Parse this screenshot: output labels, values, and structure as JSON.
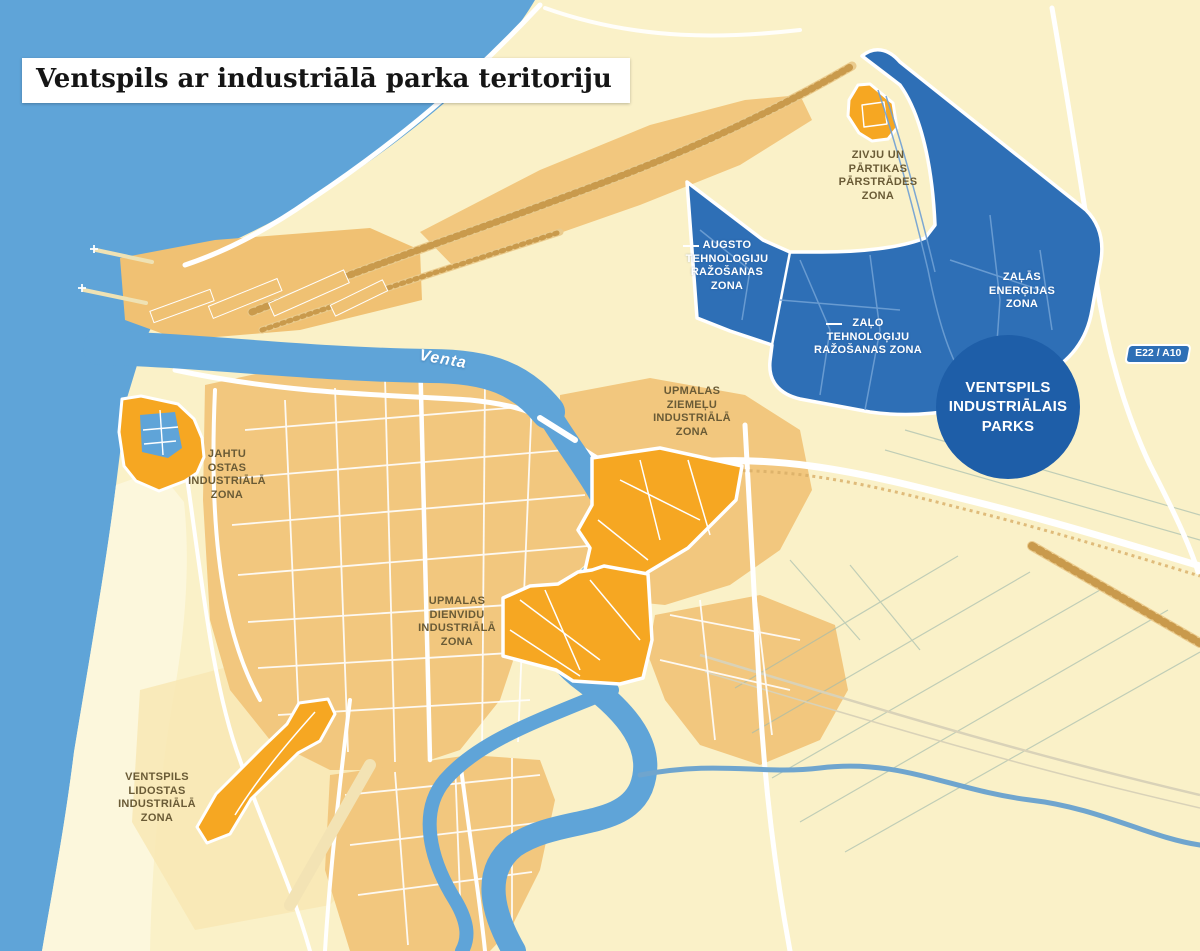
{
  "title": "Ventspils ar industriālā parka teritoriju",
  "labels": {
    "river": "Venta",
    "road_badge": "E22 / A10",
    "park_circle": "VENTSPILS\nINDUSTRIĀLAIS\nPARKS"
  },
  "zones": {
    "fish_food": {
      "label": "ZIVJU UN\nPĀRTIKAS\nPĀRSTRĀDES\nZONA",
      "category": "industrial-park-orange"
    },
    "high_tech": {
      "label": "AUGSTO\nTEHNOLOĢIJU\nRAŽOŠANAS\nZONA",
      "category": "industrial-park-blue"
    },
    "green_tech": {
      "label": "ZAĻO\nTEHNOLOĢIJU\nRAŽOŠANAS ZONA",
      "category": "industrial-park-blue"
    },
    "green_energy": {
      "label": "ZAĻĀS\nENERĢIJAS\nZONA",
      "category": "industrial-park-blue"
    },
    "upmalas_north": {
      "label": "UPMALAS\nZIEMEĻU\nINDUSTRIĀLĀ\nZONA",
      "category": "city-industrial-orange"
    },
    "yacht_port": {
      "label": "JAHTU\nOSTAS\nINDUSTRIĀLĀ\nZONA",
      "category": "city-industrial-orange"
    },
    "upmalas_south": {
      "label": "UPMALAS\nDIENVIDU\nINDUSTRIĀLĀ\nZONA",
      "category": "city-industrial-orange"
    },
    "airport": {
      "label": "VENTSPILS\nLIDOSTAS\nINDUSTRIĀLĀ\nZONA",
      "category": "city-industrial-orange"
    }
  },
  "colors": {
    "sea": "#5FA4D8",
    "land": "#FAF1C8",
    "urban": "#F2C77E",
    "industrial_zone_orange": "#F6A722",
    "park_zone_blue": "#2E6FB6",
    "park_circle_blue": "#1E5EA8",
    "label_brown": "#6A5B36",
    "road": "#FFFFFF"
  }
}
